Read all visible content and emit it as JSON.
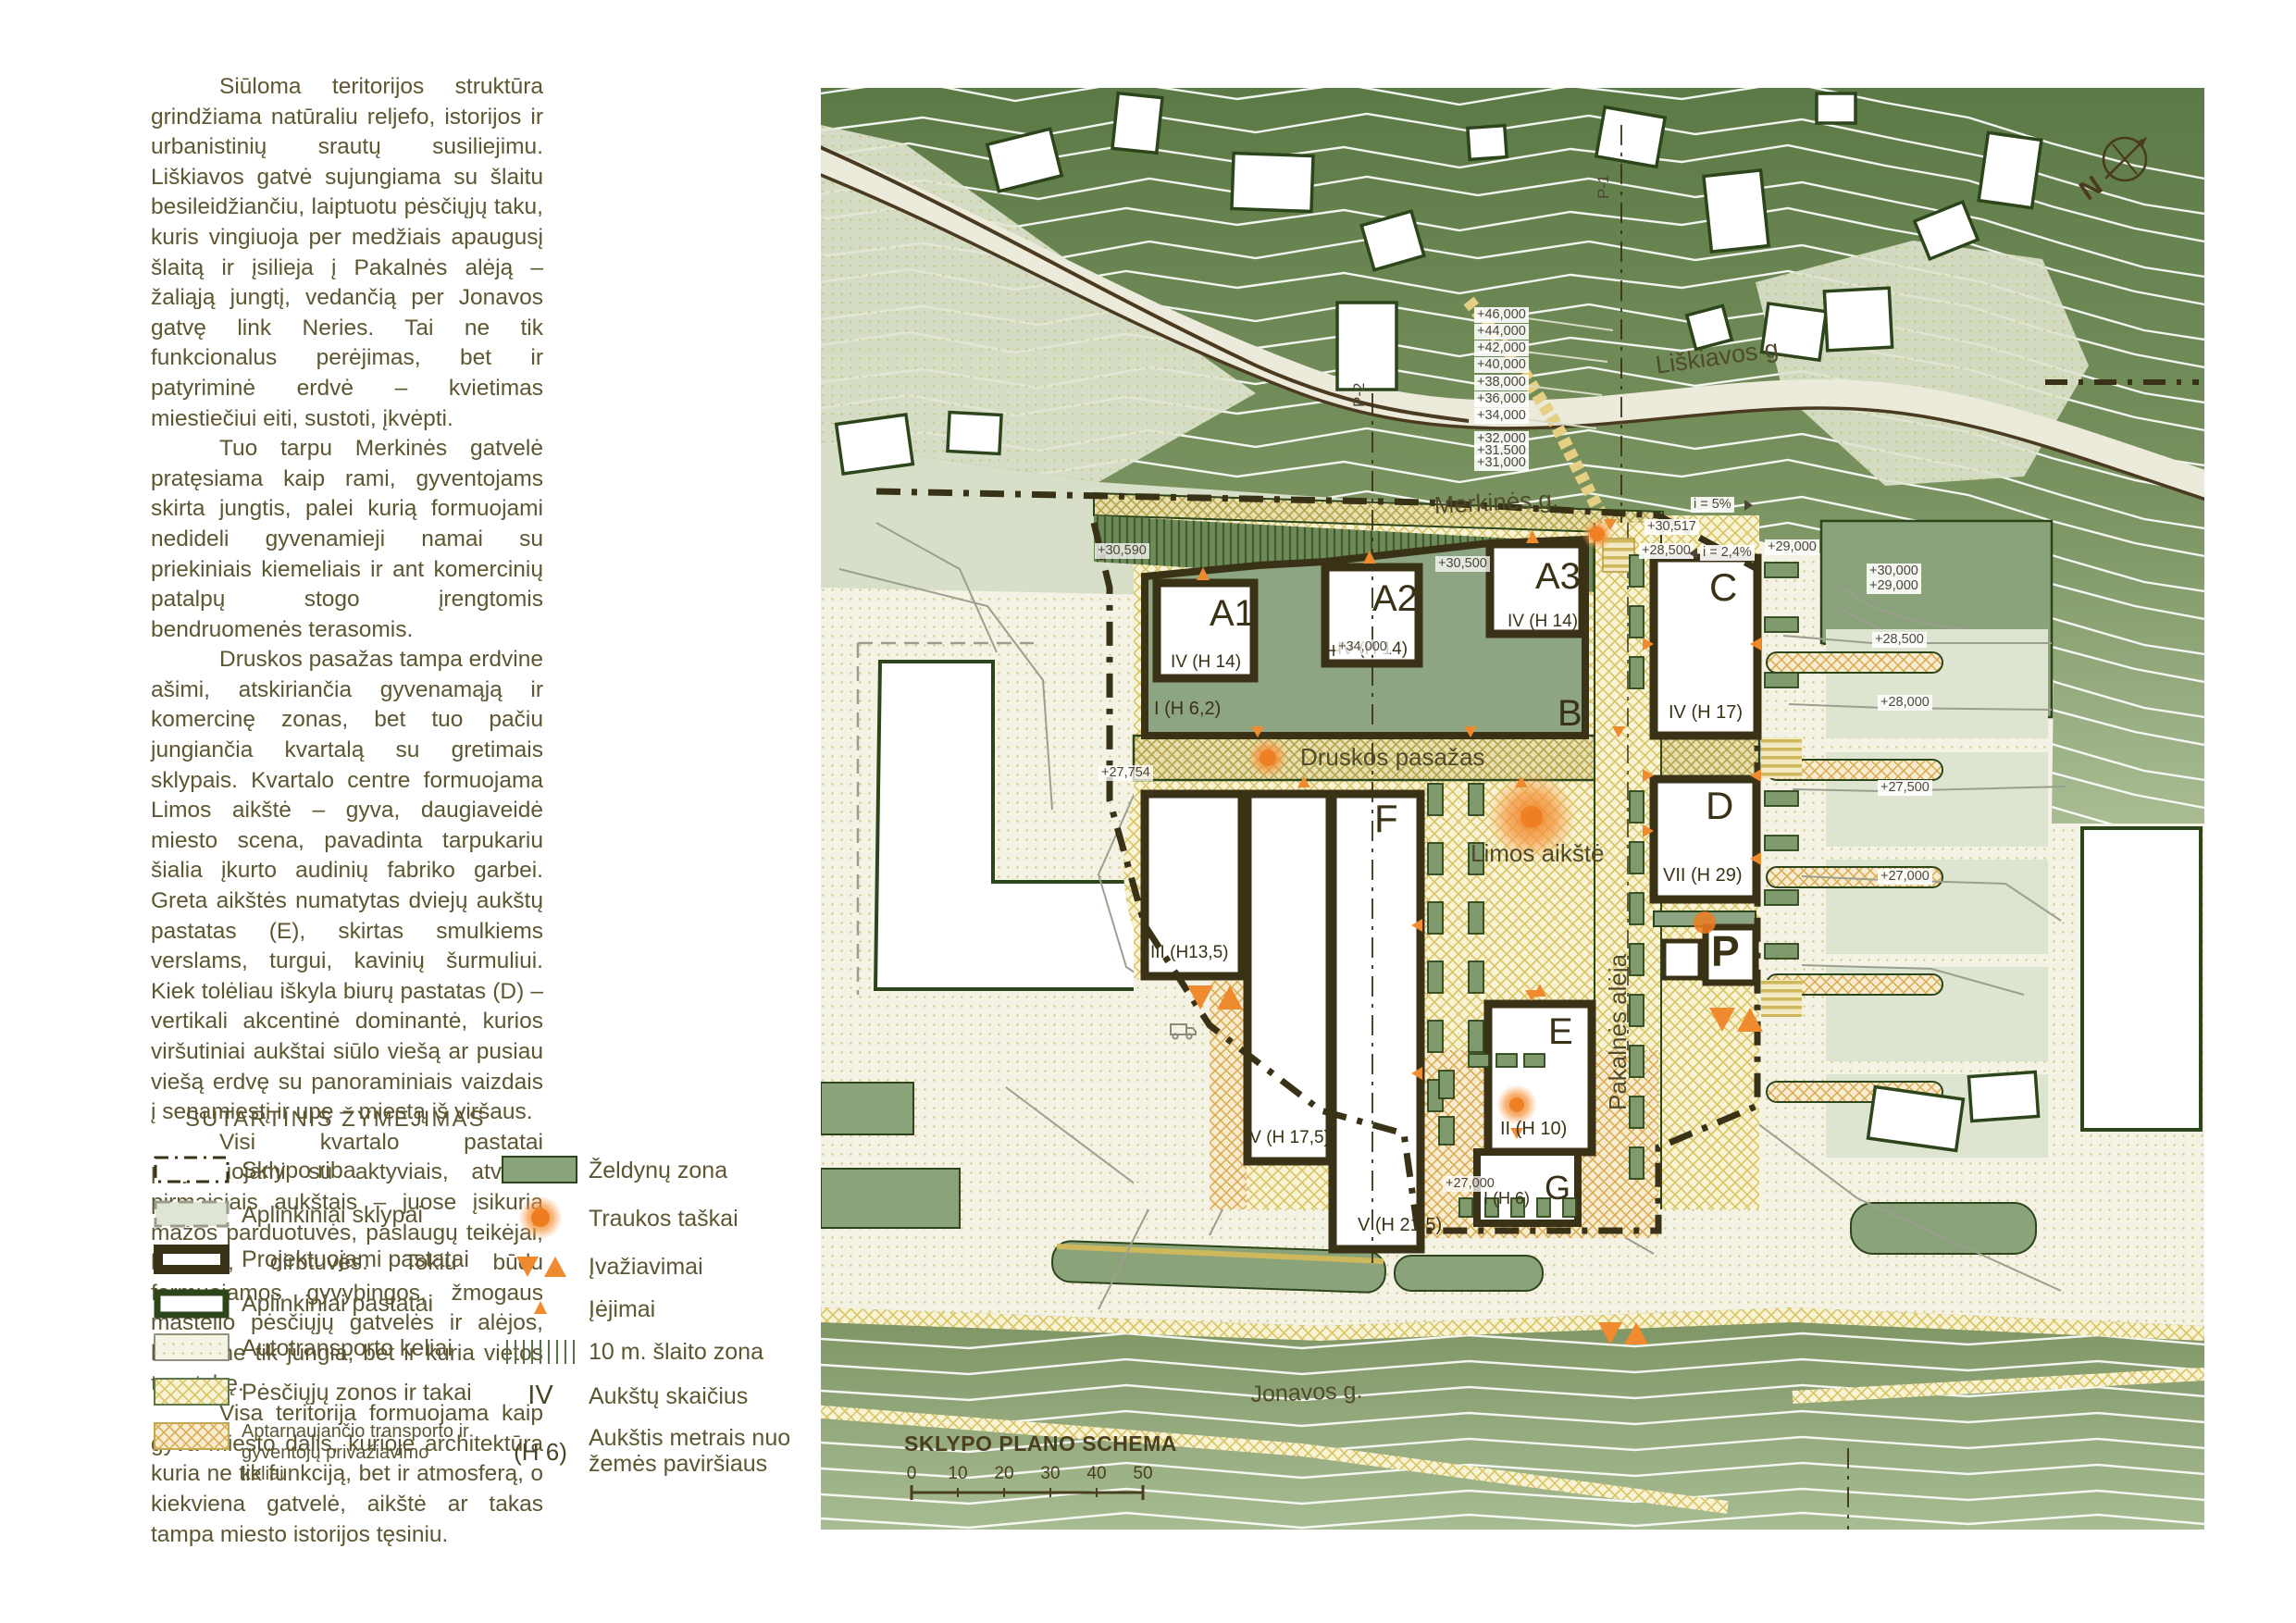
{
  "content": {
    "paragraphs": [
      "Siūloma teritorijos struktūra grindžiama natūraliu reljefo, istorijos ir urbanistinių srautų susiliejimu. Liškiavos gatvė sujungiama su šlaitu besileidžiančiu, laiptuotu pėsčiųjų taku, kuris vingiuoja per medžiais apaugusį šlaitą ir įsilieja į Pakalnės alėją – žaliąją jungtį, vedančią per Jonavos gatvę link Neries. Tai ne tik funkcionalus perėjimas, bet ir patyriminė erdvė – kvietimas miestiečiui eiti, sustoti, įkvėpti.",
      "Tuo tarpu Merkinės gatvelė pratęsiama kaip rami, gyventojams skirta jungtis, palei kurią formuojami nedideli gyvenamieji namai su priekiniais kiemeliais ir ant komercinių patalpų stogo įrengtomis bendruomenės terasomis.",
      "Druskos pasažas tampa erdvine ašimi, atskiriančia gyvenamąją ir komercinę zonas, bet tuo pačiu jungiančia kvartalą su gretimais sklypais. Kvartalo centre formuojama Limos aikštė – gyva, daugiaveidė miesto scena, pavadinta tarpukariu šialia įkurto audinių fabriko garbei. Greta aikštės numatytas dviejų aukštų pastatas (E), skirtas smulkiems verslams, turgui, kavinių šurmuliui. Kiek tolėliau iškyla biurų pastatas (D) – vertikali akcentinė dominantė, kurios viršutiniai aukštai siūlo viešą ar pusiau viešą erdvę su panoraminiais vaizdais į senamiestį ir upę – miestą iš viršaus.",
      "Visi kvartalo pastatai projektuojami su aktyviais, atvirais pirmaisiais aukštais – juose įsikuria mažos parduotuvės, paslaugų teikėjai, kavinės, dirbtuvės. Tokiu būdu formuojamos gyvybingos, žmogaus mastelio pėsčiųjų gatvelės ir alėjos, kurios ne tik jungia, bet ir kuria vietos tapatybę.",
      "Visa teritorija formuojama kaip gyva miesto dalis, kurioje architektūra kuria ne tik funkciją, bet ir atmosferą, o kiekviena gatvelė, aikštė ar takas tampa miesto istorijos tęsiniu."
    ]
  },
  "legend": {
    "title": "SUTARTINIS ŽYMĖJIMAS",
    "left": [
      {
        "label": "Sklypo riba"
      },
      {
        "label": "Aplinkiniai sklypai"
      },
      {
        "label": "Projektuojami pastatai"
      },
      {
        "label": "Aplinkiniai pastatai"
      },
      {
        "label": "Autotransporto keliai"
      },
      {
        "label": "Pėsčiųjų zonos ir takai"
      },
      {
        "label": "Aptarnaujančio transporto ir gyventojų privažiavimo keliai"
      }
    ],
    "right": [
      {
        "label": "Želdynų zona"
      },
      {
        "label": "Traukos taškai"
      },
      {
        "label": "Įvažiavimai"
      },
      {
        "label": "Įėjimai"
      },
      {
        "label": "10 m. šlaito zona"
      },
      {
        "symbol": "IV",
        "label": "Aukštų skaičius"
      },
      {
        "symbol": "(H 6)",
        "label": "Aukštis metrais nuo žemės paviršiaus"
      }
    ]
  },
  "map": {
    "schema_title": "SKLYPO PLANO SCHEMA",
    "scale_ticks": [
      "0",
      "10",
      "20",
      "30",
      "40",
      "50"
    ],
    "north_label": "N",
    "streets": {
      "liskiavos": "Liškiavos g.",
      "merkines": "Merkinės g.",
      "druskos": "Druskos pasažas",
      "limos": "Limos aikštė",
      "pakalnes": "Pakalnės alėja",
      "jonavos": "Jonavos g."
    },
    "sections": {
      "p1": "P-1",
      "p2": "P-2"
    },
    "buildings": {
      "a1": {
        "letter": "A1",
        "floors": "IV (H 14)"
      },
      "a2": {
        "letter": "A2",
        "floors": "IV (H 14)"
      },
      "a3": {
        "letter": "A3",
        "floors": "IV (H 14)"
      },
      "b": {
        "letter": "B",
        "floors": "I (H 6,2)"
      },
      "c": {
        "letter": "C",
        "floors": "IV (H 17)"
      },
      "d": {
        "letter": "D",
        "floors": "VII (H 29)"
      },
      "e": {
        "letter": "E",
        "floors": "II (H 10)"
      },
      "f": {
        "letter": "F",
        "floors": "V (H 21,5)"
      },
      "f2": {
        "floors": "IV (H 17,5)"
      },
      "f3": {
        "floors": "III (H13,5)"
      },
      "g": {
        "letter": "G",
        "floors": "I (H 6)"
      },
      "p": {
        "letter": "P"
      }
    },
    "elevations": {
      "slope": [
        "+46,000",
        "+44,000",
        "+42,000",
        "+40,000",
        "+38,000",
        "+36,000",
        "+34,000",
        "+32,000",
        "+31,500",
        "+31,000"
      ],
      "mid": [
        "+30,590",
        "+30,500",
        "+34,000",
        "+30,517",
        "+28,500",
        "+29,000",
        "+27,754",
        "+27,000"
      ],
      "grades": [
        "i = 5%",
        "i = 2,4%"
      ],
      "east": [
        "+30,000",
        "+29,000",
        "+28,500",
        "+28,000",
        "+27,500",
        "+27,000"
      ]
    },
    "colors": {
      "accent_orange": "#f08a2e",
      "proposed_outline": "#3a3217",
      "existing_outline": "#2c451b",
      "slope_green": "#5c7a46",
      "zone_green": "#8ba37a",
      "ped_hatch": "#d9c466"
    }
  }
}
